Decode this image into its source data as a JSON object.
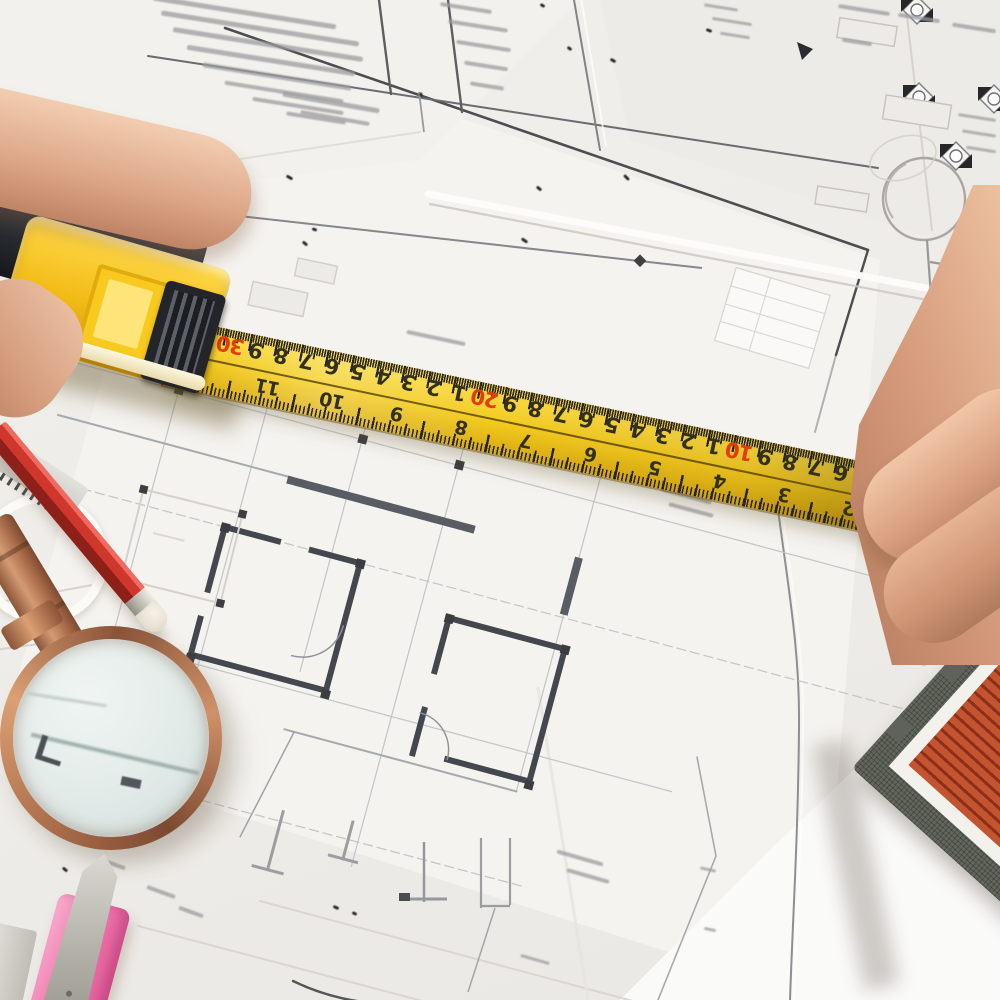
{
  "scene": {
    "type": "photograph",
    "description": "Top-down photo of hands measuring architectural floor-plan blueprints with a yellow tape measure; a magnifying glass, red pencil, scale ruler, pink utility knife and the corner of a model house roof rest on the drawings.",
    "objects": [
      "architectural blueprints",
      "yellow tape measure",
      "left hand",
      "right hand fingers",
      "magnifying glass",
      "red pencil",
      "serrated scale ruler",
      "pink utility knife",
      "model house roof corner"
    ]
  },
  "palette": {
    "paper": "#f2f1ee",
    "blueprint_line": "#8b8e94",
    "tape_yellow": "#f2c91e",
    "tape_decade_red": "#e33d00",
    "tape_digits": "#32301f",
    "skin": "#d9a181",
    "magnifier_copper": "#b5764f",
    "pencil_red": "#d0372c",
    "knife_pink": "#ef76ad",
    "house_roof_red": "#b5431f",
    "house_base_gray": "#63665d"
  },
  "tape_measure": {
    "brand_mark": "Ef",
    "end_mark": "¾",
    "cm_scale": {
      "unit": "cm",
      "numbers": [
        {
          "x": 60,
          "v": "30",
          "red": true
        },
        {
          "x": 86,
          "v": "9"
        },
        {
          "x": 112,
          "v": "8"
        },
        {
          "x": 138,
          "v": "7"
        },
        {
          "x": 164,
          "v": "6"
        },
        {
          "x": 190,
          "v": "5"
        },
        {
          "x": 216,
          "v": "4"
        },
        {
          "x": 242,
          "v": "3"
        },
        {
          "x": 268,
          "v": "2"
        },
        {
          "x": 294,
          "v": "1"
        },
        {
          "x": 320,
          "v": "20",
          "red": true
        },
        {
          "x": 346,
          "v": "9"
        },
        {
          "x": 372,
          "v": "8"
        },
        {
          "x": 398,
          "v": "7"
        },
        {
          "x": 424,
          "v": "6"
        },
        {
          "x": 450,
          "v": "5"
        },
        {
          "x": 476,
          "v": "4"
        },
        {
          "x": 502,
          "v": "3"
        },
        {
          "x": 528,
          "v": "2"
        },
        {
          "x": 554,
          "v": "1"
        },
        {
          "x": 580,
          "v": "10",
          "red": true
        },
        {
          "x": 606,
          "v": "9"
        },
        {
          "x": 632,
          "v": "8"
        },
        {
          "x": 658,
          "v": "7"
        },
        {
          "x": 684,
          "v": "6"
        },
        {
          "x": 710,
          "v": "5"
        }
      ]
    },
    "inch_scale": {
      "unit": "inch",
      "numbers": [
        {
          "x": 105,
          "v": "11"
        },
        {
          "x": 171,
          "v": "10"
        },
        {
          "x": 237,
          "v": "9"
        },
        {
          "x": 303,
          "v": "8"
        },
        {
          "x": 369,
          "v": "7"
        },
        {
          "x": 435,
          "v": "6"
        },
        {
          "x": 501,
          "v": "5"
        },
        {
          "x": 567,
          "v": "4"
        },
        {
          "x": 633,
          "v": "3"
        },
        {
          "x": 699,
          "v": "2"
        }
      ]
    }
  }
}
